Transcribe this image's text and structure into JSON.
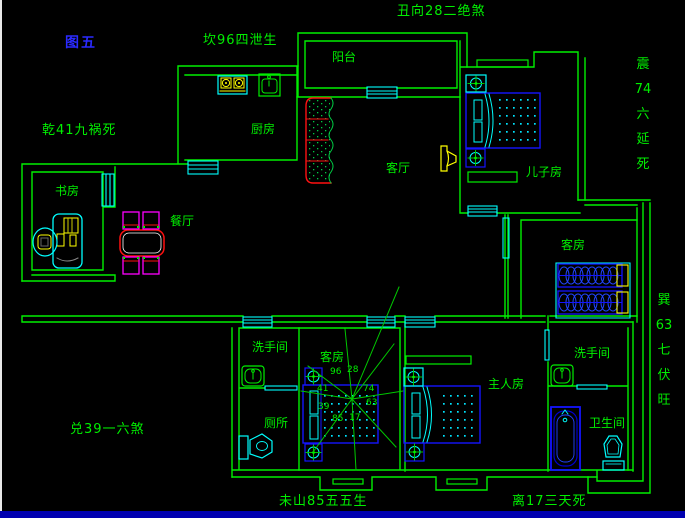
{
  "figure_label": "图五",
  "annotations": {
    "top_center": "坎96四泄生",
    "top_right": "丑向28二绝煞",
    "left": "乾41九祸死",
    "right_upper": "震\n74\n六\n延\n死",
    "right_lower": "巽\n63\n七\n伏\n旺",
    "bottom_left": "兑39一六煞",
    "bottom_center": "未山85五五生",
    "bottom_right": "离17三天死"
  },
  "rooms": {
    "balcony": "阳台",
    "kitchen": "厨房",
    "living_room": "客厅",
    "sons_room": "儿子房",
    "guest_room_upper": "客房",
    "study": "书房",
    "dining_room": "餐厅",
    "washroom_left": "洗手间",
    "toilet": "厕所",
    "guest_room_lower": "客房",
    "master_room": "主人房",
    "washroom_right": "洗手间",
    "bathroom": "卫生间"
  },
  "compass": {
    "nw": "41",
    "n": "96",
    "ne": "28",
    "e": "74",
    "se": "63",
    "s": "17",
    "sw": "85",
    "w": "39"
  },
  "icons": {
    "stove": "stove-icon",
    "kitchen_sink": "sink-icon",
    "sofa": "sofa-icon",
    "tv": "tv-icon",
    "bed": "bed-icon",
    "nightstand": "nightstand-target-icon",
    "desk": "desk-icon",
    "chair": "chair-icon",
    "dining_table": "dining-table-icon",
    "washbasin": "washbasin-icon",
    "toilet": "toilet-icon",
    "bathtub": "bathtub-icon"
  },
  "colors": {
    "wall": "#00ef00",
    "window": "#00ffff",
    "furniture_blue": "#1414ff",
    "accent_yellow": "#ffff00",
    "sofa_red": "#ff1111",
    "chair_magenta": "#ff00ff",
    "label_green": "#00ef00",
    "figure_blue": "#2a2aff",
    "bottom_bar": "#0000b0"
  }
}
